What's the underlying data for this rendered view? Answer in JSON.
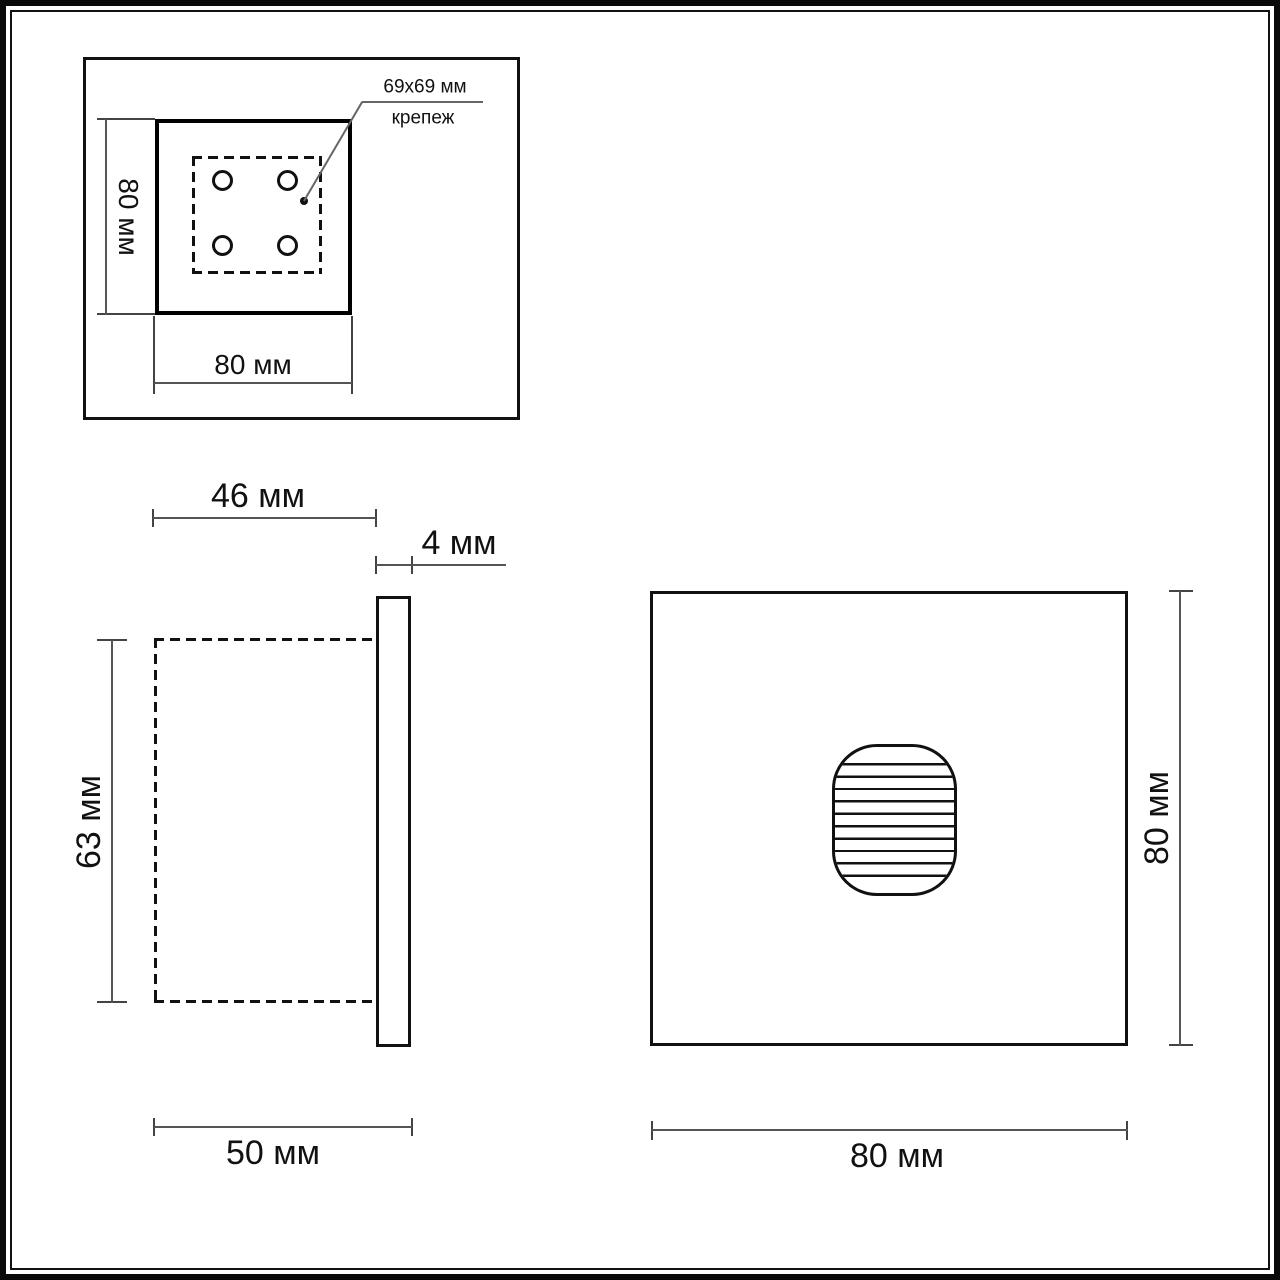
{
  "drawing": {
    "back_view": {
      "height_label": "80 мм",
      "width_label": "80 мм",
      "callout_size": "69x69 мм",
      "callout_name": "крепеж"
    },
    "side_view": {
      "recess_depth_label": "46 мм",
      "plate_thickness_label": "4 мм",
      "body_height_label": "63 мм",
      "total_depth_label": "50 мм"
    },
    "front_view": {
      "height_label": "80 мм",
      "width_label": "80 мм"
    }
  },
  "colors": {
    "line": "#111111",
    "dimension_line": "#555555",
    "background": "#ffffff"
  }
}
